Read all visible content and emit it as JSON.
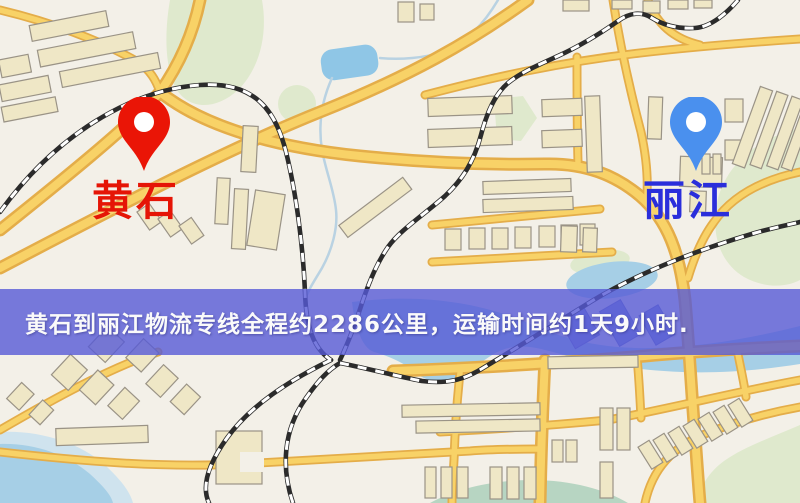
{
  "map": {
    "markers": [
      {
        "id": "origin",
        "label": "黄石",
        "pin_color": "#ea1506",
        "label_color": "#e51506"
      },
      {
        "id": "destination",
        "label": "丽江",
        "pin_color": "#4a90ee",
        "label_color": "#2a2edb"
      }
    ]
  },
  "banner": {
    "text": "黄石到丽江物流专线全程约2286公里，运输时间约1天9小时.",
    "background_color": "rgba(86,90,214,0.8)",
    "text_color": "#fafafa"
  },
  "route": {
    "origin": "黄石",
    "destination": "丽江",
    "distance_text": "约2286公里",
    "duration_text": "约1天9小时"
  },
  "colors": {
    "land": "#f3f0e8",
    "road_fill": "#f8d267",
    "road_casing": "#e4ad49",
    "building": "#efe7c6",
    "building_outline": "#9a9386",
    "park": "#dfe9cd",
    "water": "#a6cfe6",
    "railway": "#2b2b2b"
  }
}
